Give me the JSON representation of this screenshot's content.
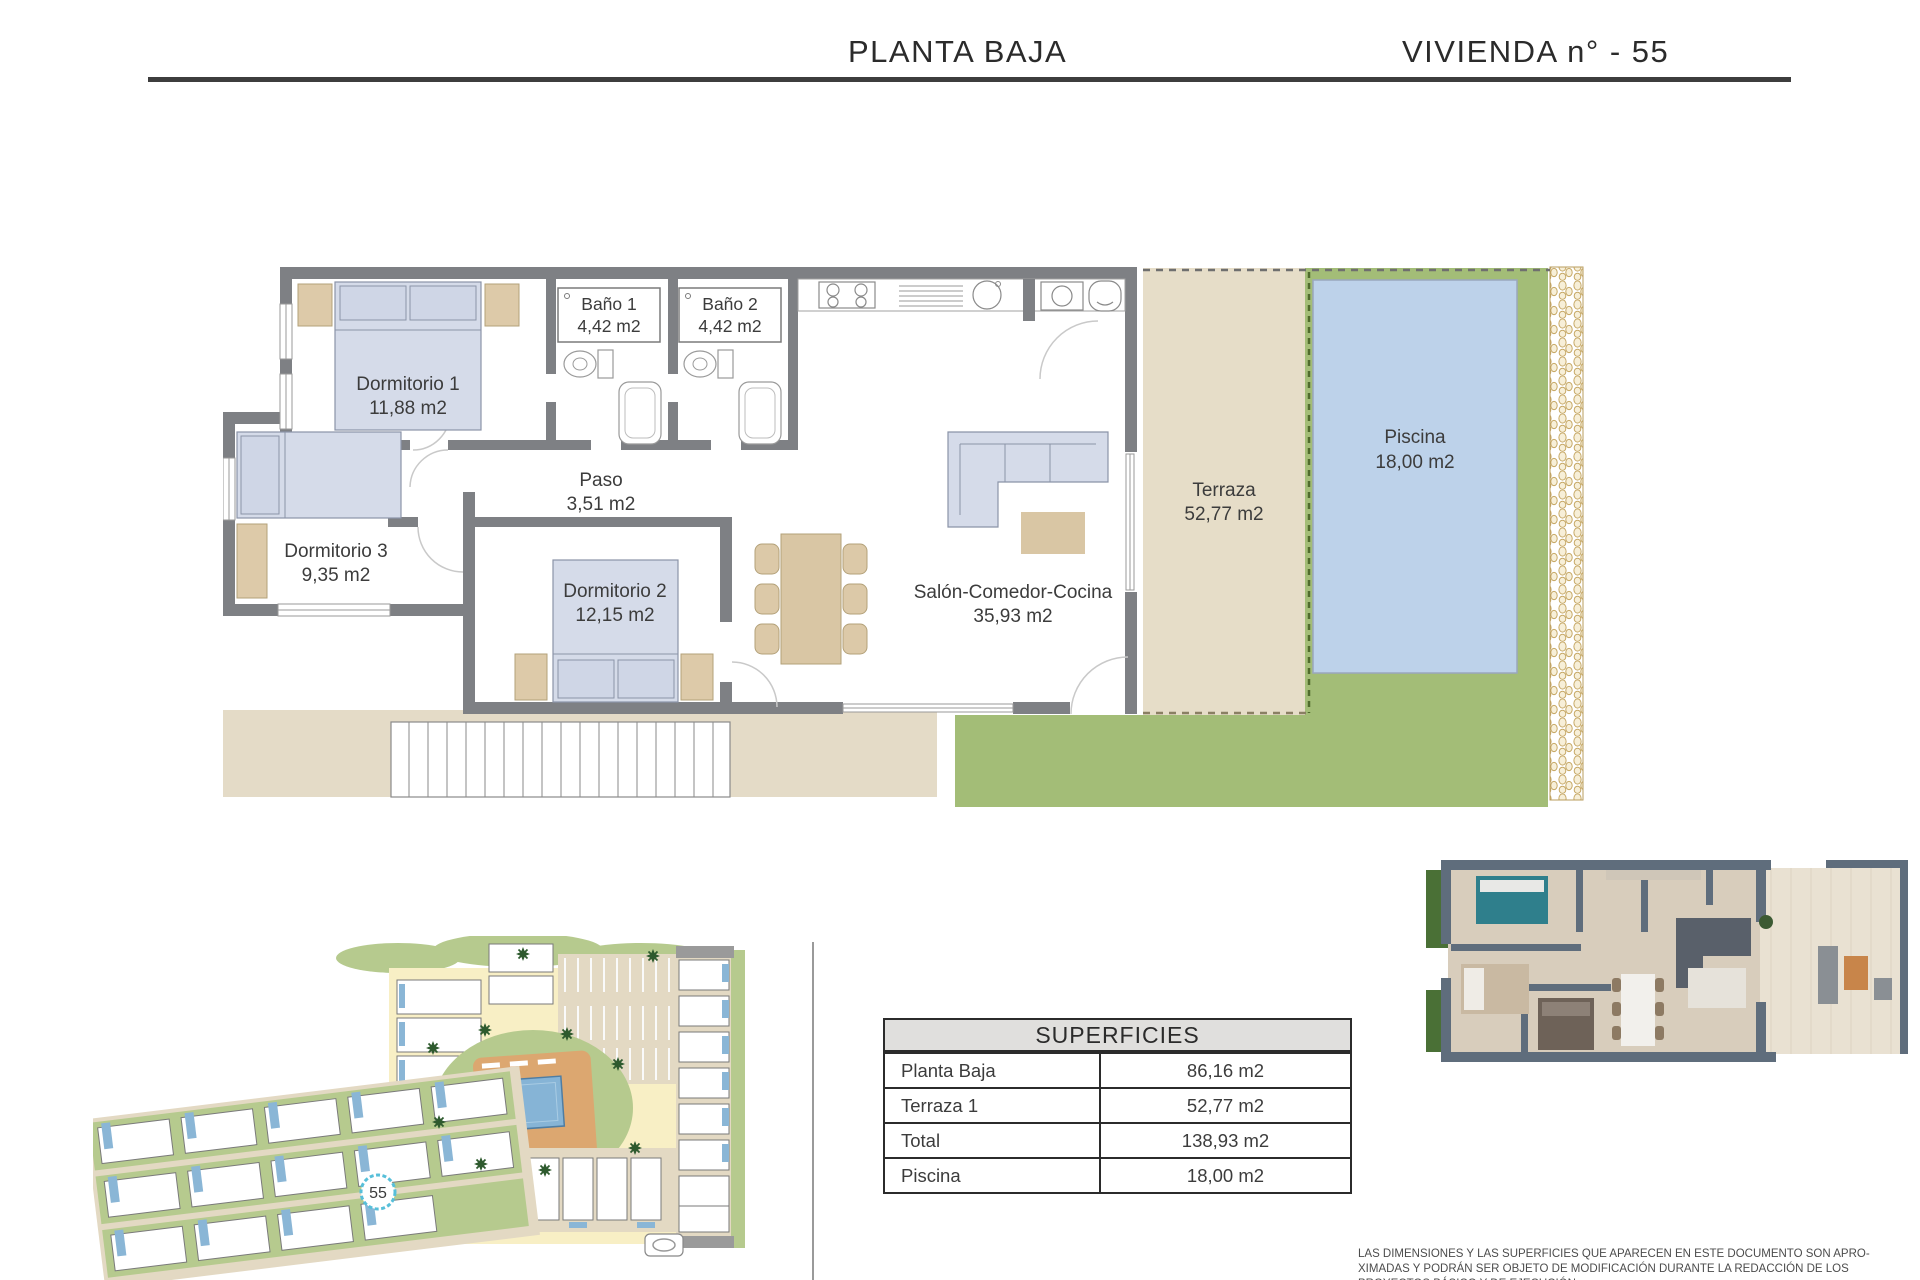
{
  "header": {
    "title_left": "PLANTA BAJA",
    "title_right": "VIVIENDA n° - 55"
  },
  "plan": {
    "rooms": [
      {
        "name": "Dormitorio 1",
        "area": "11,88 m2"
      },
      {
        "name": "Baño 1",
        "area": "4,42 m2"
      },
      {
        "name": "Baño 2",
        "area": "4,42 m2"
      },
      {
        "name": "Dormitorio 3",
        "area": "9,35 m2"
      },
      {
        "name": "Paso",
        "area": "3,51 m2"
      },
      {
        "name": "Dormitorio 2",
        "area": "12,15 m2"
      },
      {
        "name": "Salón-Comedor-Cocina",
        "area": "35,93 m2"
      },
      {
        "name": "Terraza",
        "area": "52,77 m2"
      },
      {
        "name": "Piscina",
        "area": "18,00 m2"
      }
    ],
    "colors": {
      "wall": "#7e8084",
      "terrace": "#e6ddc8",
      "pool": "#bdd2ea",
      "lawn": "#a3bd77",
      "furniture_blue": "#d5dbe9",
      "furniture_tan": "#ddcaa9",
      "pavement": "#e4dbc7"
    }
  },
  "site_plan": {
    "unit_marker": "55",
    "marker_color": "#57bfd9"
  },
  "table": {
    "title": "SUPERFICIES",
    "rows": [
      {
        "label": "Planta Baja",
        "value": "86,16 m2"
      },
      {
        "label": "Terraza 1",
        "value": "52,77 m2"
      },
      {
        "label": "Total",
        "value": "138,93 m2"
      },
      {
        "label": "Piscina",
        "value": "18,00 m2"
      }
    ]
  },
  "disclaimer": {
    "line1": "LAS DIMENSIONES Y LAS SUPERFICIES QUE APARECEN EN ESTE DOCUMENTO SON APRO-",
    "line2": "XIMADAS Y PODRÁN SER OBJETO DE MODIFICACIÓN DURANTE LA REDACCIÓN DE LOS",
    "line3": "PROYECTOS BÁSICO Y DE EJECUCIÓN."
  }
}
